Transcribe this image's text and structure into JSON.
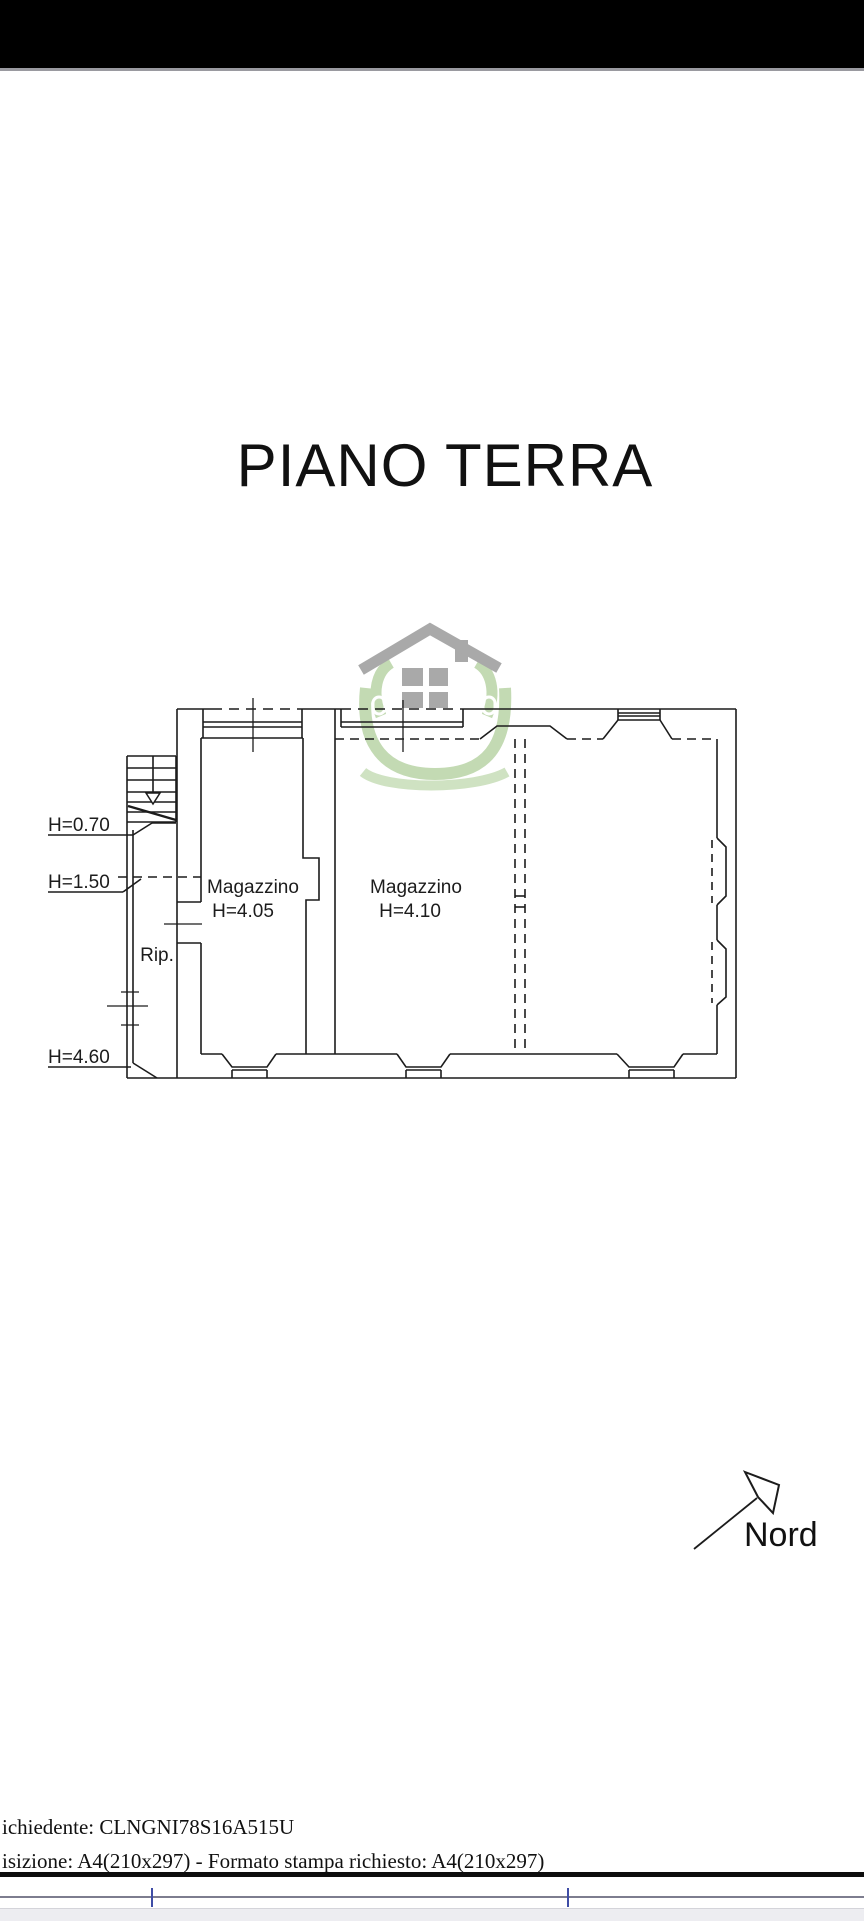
{
  "page": {
    "title": "PIANO TERRA"
  },
  "plan": {
    "rooms": [
      {
        "name": "Magazzino",
        "height_label": "H=4.05"
      },
      {
        "name": "Magazzino",
        "height_label": "H=4.10"
      },
      {
        "name": "Rip."
      }
    ],
    "height_annotations": [
      "H=0.70",
      "H=1.50",
      "H=4.60"
    ],
    "north_label": "Nord"
  },
  "watermark": {
    "icon": "house-in-hands-logo"
  },
  "footer": {
    "line1": "ichiedente: CLNGNI78S16A515U",
    "line2": "isizione: A4(210x297)  - Formato stampa richiesto: A4(210x297)"
  },
  "colors": {
    "line": "#1c1c1c",
    "logo_gray": "#a9a9a9",
    "logo_green": "#c3dab3",
    "ruler_tick_blue": "#3f4da6",
    "top_bar": "#000000"
  }
}
